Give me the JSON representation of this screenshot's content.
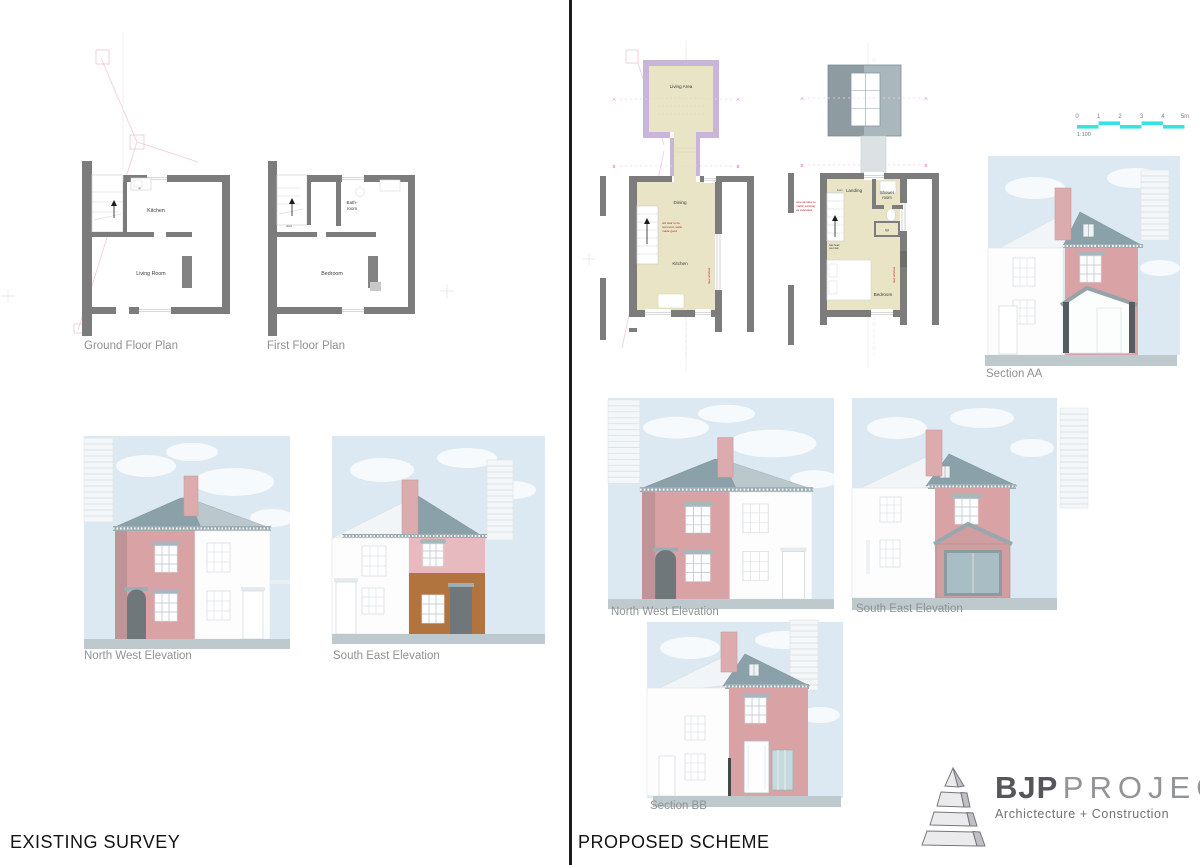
{
  "titles": {
    "existing": "EXISTING SURVEY",
    "proposed": "PROPOSED SCHEME"
  },
  "existing": {
    "ground_floor": {
      "title": "Ground Floor Plan",
      "kitchen": "Kitchen",
      "living_room": "Living Room",
      "stair_note": "up"
    },
    "first_floor": {
      "title": "First Floor Plan",
      "bath_line1": "Bath-",
      "bath_line2": "room",
      "bedroom": "Bedroom",
      "stair_note": "down"
    },
    "nw_title": "North West Elevation",
    "se_title": "South East Elevation"
  },
  "proposed": {
    "ground_floor": {
      "living_area": "Living Area",
      "dining": "Dining",
      "kitchen": "Kitchen",
      "marker_a": "A",
      "marker_b": "B",
      "annotation_lines": [
        "old stair to be",
        "removed, walls",
        "made good"
      ],
      "annotation_vertical": "new window"
    },
    "first_floor": {
      "landing": "Landing",
      "landing_note": "linen",
      "shower_line1": "Shower",
      "shower_line2": "room",
      "wardrobe": "W",
      "bedroom": "Bedroom",
      "marker_a": "A",
      "marker_b": "B",
      "annotation_lines": [
        "new window to",
        "match existing",
        "as indicated"
      ],
      "annotation_vertical": "new window",
      "stair_note_lines": [
        "bulk head",
        "over stair"
      ]
    },
    "section_aa_title": "Section AA",
    "nw_title": "North West Elevation",
    "se_title": "South East Elevation",
    "section_bb_title": "Section BB"
  },
  "scale_bar": {
    "ticks": [
      "0",
      "1",
      "2",
      "3",
      "4",
      "5m"
    ],
    "ratio": "1:100"
  },
  "logo": {
    "brand_bold": "BJP",
    "brand_light": "PROJECTS",
    "tagline": "Archictecture + Construction"
  },
  "colors": {
    "sky": "#dde9f2",
    "roof_dark": "#8ba1a9",
    "roof_light": "#bac8ce",
    "house_pink": "#d9a2a4",
    "house_pink_upper": "#e6babe",
    "house_brown": "#b2743f",
    "chimney": "#dcabad",
    "door": "#70777b",
    "ground": "#bdc9cc",
    "plan_wall": "#7c7c7c",
    "plan_floor": "#e9e4c6",
    "new_wall": "#c9b5da",
    "marker_magenta": "#ee5fd6",
    "annotation_red": "#c32020",
    "scale_cyan": "#38e2e4"
  }
}
